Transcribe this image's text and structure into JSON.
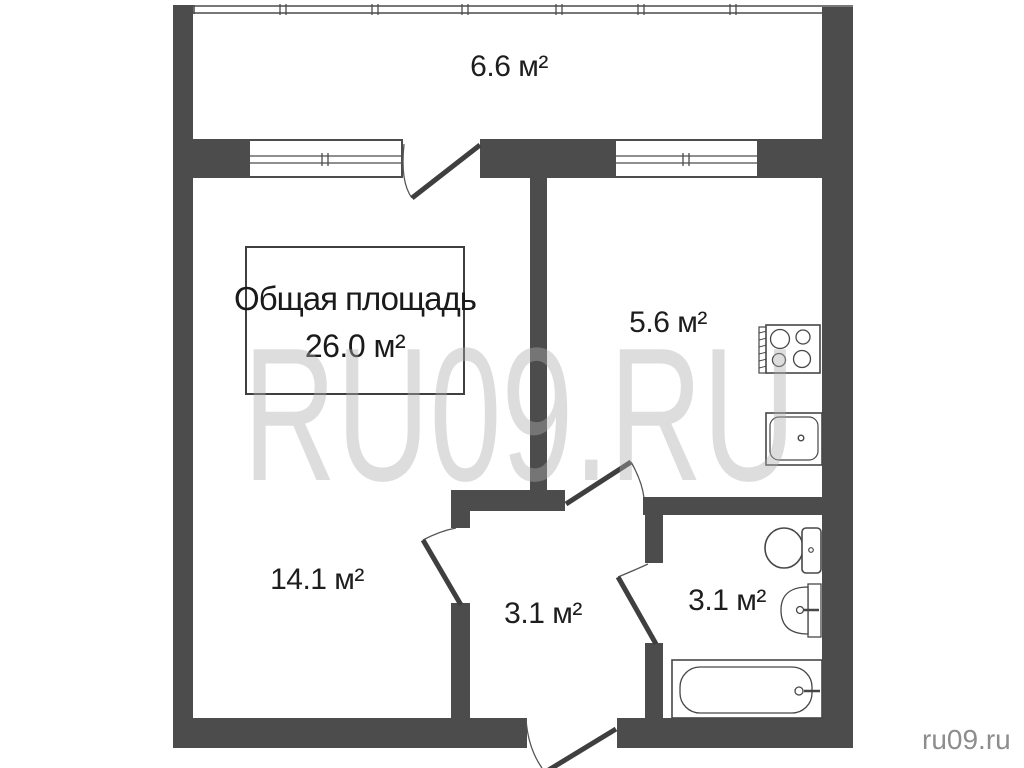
{
  "plan": {
    "type": "apartment-floor-plan",
    "total_area_box": {
      "title": "Общая площадь",
      "value": "26.0 м²"
    },
    "rooms": {
      "balcony": {
        "area": "6.6 м²"
      },
      "kitchen": {
        "area": "5.6 м²"
      },
      "living_room": {
        "area": "14.1 м²"
      },
      "hallway": {
        "area": "3.1 м²"
      },
      "bathroom": {
        "area": "3.1 м²"
      }
    },
    "fixtures": {
      "kitchen": [
        {
          "icon": "stove-icon"
        },
        {
          "icon": "kitchen-sink-icon"
        }
      ],
      "bathroom": [
        {
          "icon": "toilet-icon"
        },
        {
          "icon": "washbasin-icon"
        },
        {
          "icon": "bathtub-icon"
        }
      ]
    },
    "openings": {
      "windows": 2,
      "doors": [
        "balcony-door",
        "kitchen-door",
        "living-room-door",
        "bathroom-door",
        "entrance-door"
      ]
    }
  },
  "watermark": {
    "large": "RU09.RU",
    "corner": "ru09.ru"
  },
  "colors": {
    "wall": "#4c4c4c",
    "fixture_line": "#474747",
    "text": "#1e1e1e",
    "watermark": "#adadad",
    "corner_text": "#8d8d8d",
    "background": "#ffffff"
  }
}
